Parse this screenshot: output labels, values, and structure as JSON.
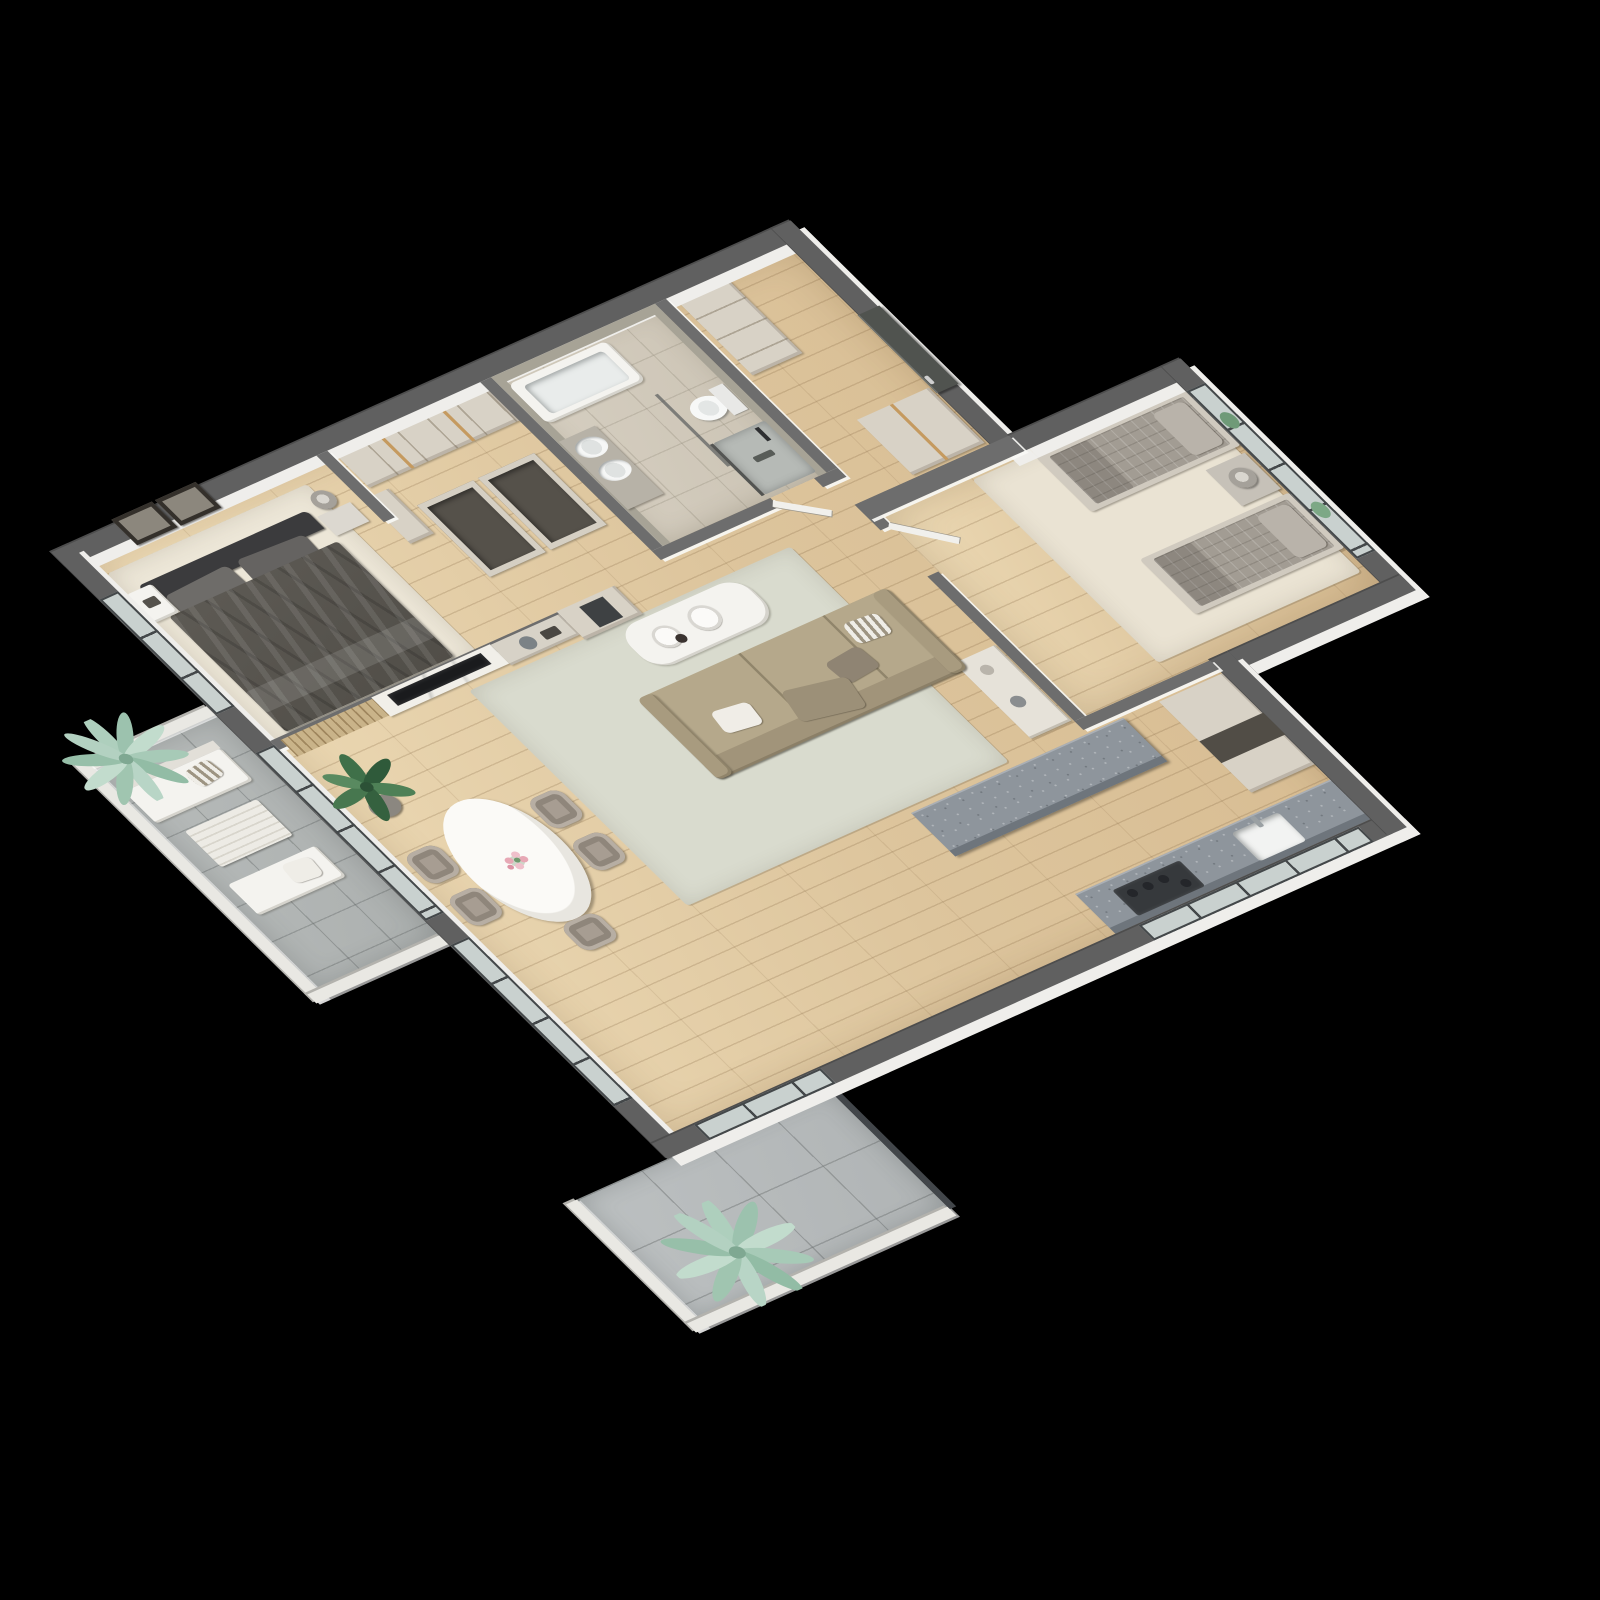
{
  "scene": {
    "title": "3D isometric floor plan render — two-bedroom apartment",
    "background": "#000000",
    "view": "top-down isometric"
  },
  "palette": {
    "wall_top": "#6d6d6d",
    "wall_exterior": "#606060",
    "wall_face_white": "#efeeeb",
    "concrete_wall": "#a7a396",
    "wood_floor": "#e2cba3",
    "bath_floor": "#d1cabd",
    "balcony_tile": "#b3b7b6",
    "terrace_tile": "#b9bdbe",
    "glass": "#d3dbd9",
    "window_frame": "#44484a",
    "entry_door": "#50534f",
    "cabinet_cream": "#d8d2c6",
    "kitchen_stone": "#8e959c",
    "sofa_beige": "#b5a88b",
    "master_duvet": "#56534d",
    "guest_quilt": "#a29c93",
    "rug_living": "#d9dbce",
    "rug_cream": "#ece6d7",
    "marble_white": "#f1efe9",
    "tv_black": "#1a1b1d",
    "palm_mint": "#aecfbd",
    "plant_green": "#3f7049",
    "flower_pink": "#e7a8b5"
  },
  "rooms": {
    "master_bedroom": {
      "name": "Master Bedroom",
      "items": [
        "double bed",
        "dark gray duvet",
        "two pillows",
        "nightstand",
        "wall shelf with lamp",
        "framed art (2)",
        "cream rug"
      ]
    },
    "dressing_area": {
      "name": "Dressing Area",
      "items": [
        "built-in wardrobe with wood trims",
        "open closet island boxes"
      ]
    },
    "bathroom": {
      "name": "Bathroom",
      "items": [
        "bathtub",
        "round washbasin",
        "bidet",
        "wall-hung toilet",
        "walk-in shower with glass",
        "concrete-finish walls"
      ]
    },
    "hallway": {
      "name": "Entrance Hall",
      "items": [
        "entry door",
        "tall cabinet",
        "wardrobe"
      ]
    },
    "bedroom_2": {
      "name": "Second Bedroom",
      "items": [
        "single bed (2)",
        "quilted gray bedding",
        "round nightstand with lamp",
        "windows with greenery",
        "cream rug",
        "open door"
      ]
    },
    "living_room": {
      "name": "Living Room",
      "items": [
        "beige sofa with chaise",
        "scatter cushions",
        "white marble coffee table",
        "decor plates",
        "TV on marble media wall",
        "wood slat panel",
        "sideboard with dark niche",
        "shelving unit",
        "pale rug"
      ]
    },
    "dining_area": {
      "name": "Dining Area",
      "items": [
        "oval white marble table",
        "flower vase",
        "dining chairs (5)",
        "potted plant"
      ]
    },
    "kitchen": {
      "name": "Kitchen",
      "items": [
        "stone island",
        "stone base counter",
        "white sink",
        "dark cooktop",
        "tall cream cabinets"
      ]
    },
    "balcony": {
      "name": "Balcony",
      "items": [
        "outdoor sofa",
        "slatted coffee table",
        "outdoor bench",
        "mint palm plant",
        "white parapet"
      ]
    },
    "terrace": {
      "name": "Terrace",
      "items": [
        "large tile floor",
        "mint palm plant",
        "glass balustrade",
        "white parapet"
      ]
    }
  }
}
